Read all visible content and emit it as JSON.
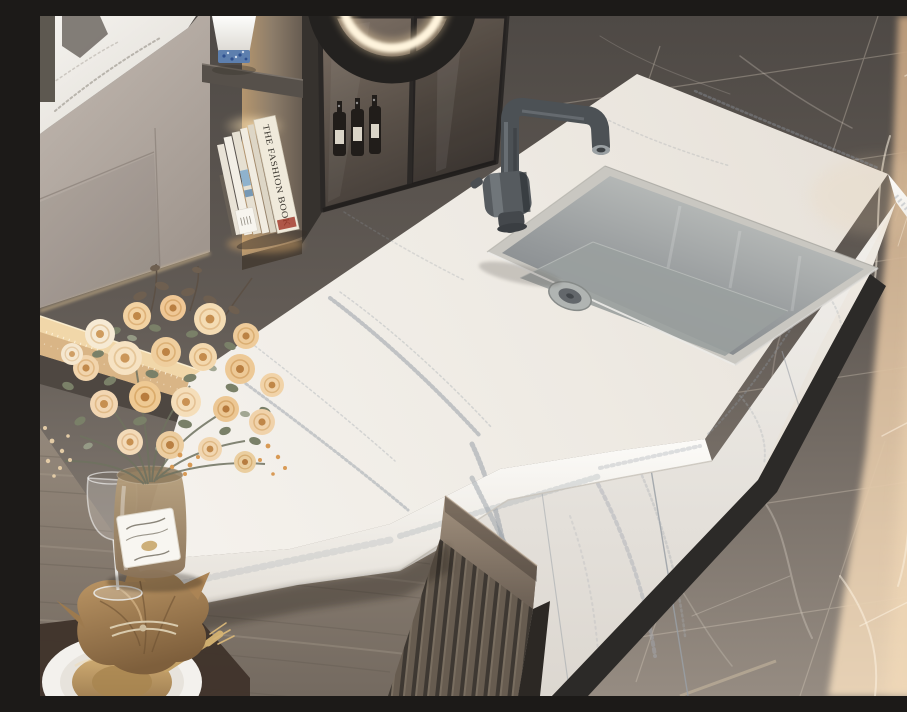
{
  "image": {
    "type": "photograph",
    "subject": "Modern kitchen with white quartz waterfall island, undermount stainless sink, matte gunmetal faucet, rose bouquet on wooden dining ledge, and dark marble floor with sunlight",
    "width": 907,
    "height": 680
  },
  "labels": {
    "book_spine": "THE FASHION BOOK"
  },
  "objects": [
    "marble-floor",
    "sunlight-patch",
    "wall-cabinets",
    "display-shelf",
    "books",
    "decor-vase",
    "glass-cabinet",
    "wine-bottles",
    "ring-light",
    "led-ledge",
    "kitchen-island",
    "countertop",
    "sink",
    "faucet",
    "island-side-panels",
    "toe-kick",
    "slat-panel",
    "dining-table",
    "placemat",
    "dinner-plate",
    "napkin",
    "fork",
    "wine-glass",
    "flower-vase",
    "rose-bouquet"
  ],
  "palette": {
    "counter_white": "#f1eee8",
    "counter_vein": "#98a0a8",
    "floor_dark": "#56514c",
    "floor_mid": "#938a80",
    "sunlight": "#e6cdb0",
    "cabinet_taupe": "#b5aca5",
    "smoked_glass": "#6e6258",
    "wood": "#8b8075",
    "slat_wood": "#6e6459",
    "gold": "#c4a267",
    "napkin_tan": "#a8825a",
    "rose_peach": "#f2cf9e",
    "leaf_sage": "#878c74",
    "steel": "#9ea2a2",
    "faucet_gunmetal": "#4c5155",
    "toe_kick": "#2c2a28",
    "led_glow": "#ffdfa8"
  }
}
